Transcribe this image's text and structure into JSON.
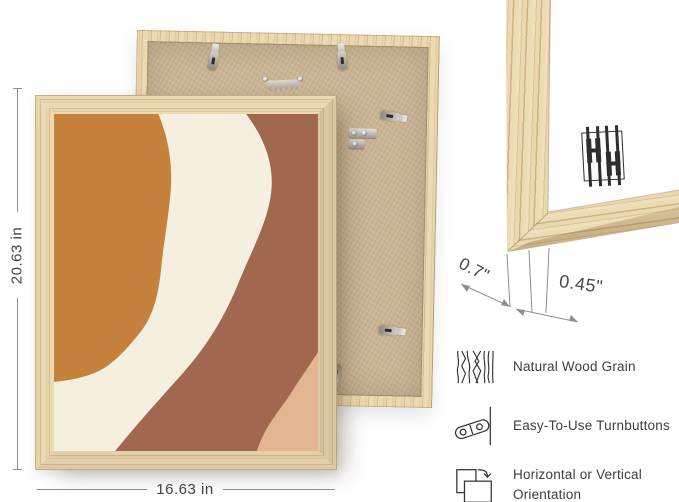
{
  "dimensions": {
    "height": "20.63 in",
    "width": "16.63 in",
    "depth": "0.7\"",
    "face_width": "0.45\""
  },
  "artwork": {
    "colors": {
      "orange": "#C6823D",
      "cream": "#F5EFDF",
      "terracotta": "#A2674F",
      "peach": "#E2B48F"
    }
  },
  "materials": {
    "frame_wood": "#E3CBA0",
    "backing_board": "#C9B495"
  },
  "features": {
    "items": [
      {
        "icon": "wood-grain-icon",
        "label": "Natural Wood Grain"
      },
      {
        "icon": "turnbutton-icon",
        "label": "Easy-To-Use Turnbuttons"
      },
      {
        "icon": "orientation-icon",
        "label": "Horizontal or Vertical Orientation"
      }
    ]
  }
}
